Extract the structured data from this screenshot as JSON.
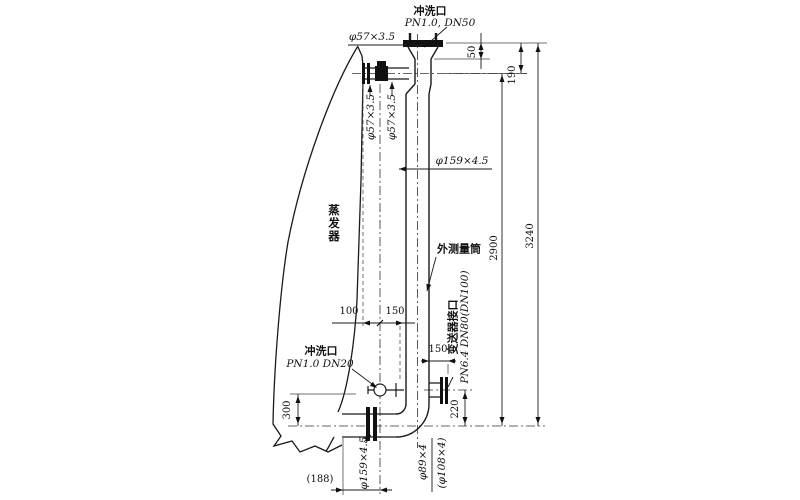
{
  "drawing": {
    "labels": {
      "top_flush_port_name": "冲洗口",
      "top_flush_port_spec": "PN1.0, DN50",
      "pipe57_top": "φ57×3.5",
      "pipe57_left": "φ57×3.5",
      "pipe57_right": "φ57×3.5",
      "cylinder_spec": "φ159×4.5",
      "evaporator": "蒸发器",
      "measuring_cylinder": "外测量筒",
      "transmitter_port_name": "变送器接口",
      "transmitter_port_spec": "PN6.4 DN80(DN100)",
      "bottom_flush_port_name": "冲洗口",
      "bottom_flush_port_spec": "PN1.0 DN20",
      "bottom_pipe_spec": "φ159×4.5",
      "drain_spec": "φ89×4",
      "drain_spec_alt": "(φ108×4)"
    },
    "dims": {
      "d50": "50",
      "d190": "190",
      "d100": "100",
      "d150_top": "150",
      "d150_stub": "150",
      "d220": "220",
      "d300": "300",
      "d2900": "2900",
      "d3240": "3240",
      "d188": "(188)"
    },
    "colors": {
      "line": "#1a1a1a",
      "background": "#ffffff"
    }
  }
}
